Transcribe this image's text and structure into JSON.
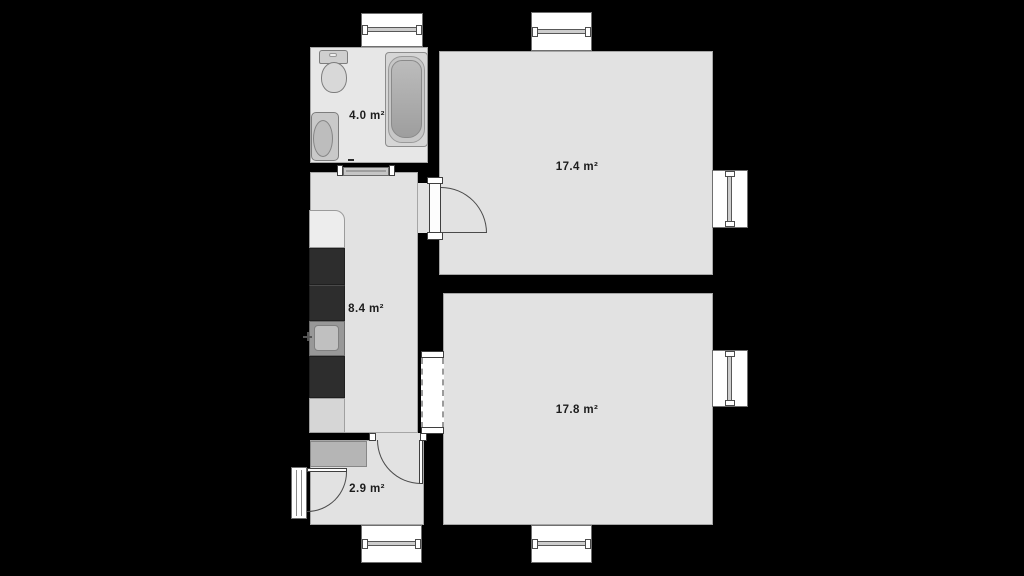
{
  "plan": {
    "title": "apartment floor plan",
    "rooms": [
      {
        "name": "bathroom",
        "area_label": "4.0 m²"
      },
      {
        "name": "room-upper",
        "area_label": "17.4 m²"
      },
      {
        "name": "kitchen",
        "area_label": "8.4 m²"
      },
      {
        "name": "room-lower",
        "area_label": "17.8 m²"
      },
      {
        "name": "entry",
        "area_label": "2.9 m²"
      }
    ],
    "fixtures": [
      "toilet",
      "bathroom-sink",
      "bathtub",
      "kitchen-counter",
      "stove",
      "kitchen-sink",
      "entry-shelf"
    ],
    "openings": {
      "windows": 6,
      "doors": [
        "door-room-upper",
        "door-entry-kitchen",
        "front-door",
        "sliding-door-bathroom"
      ],
      "passages": [
        "dashed-opening-kitchen-room-lower"
      ]
    },
    "colors": {
      "background": "#000000",
      "wall": "#000000",
      "floor": "#e2e2e2",
      "window": "#ffffff",
      "appliance_dark": "#2d2d2d",
      "fixture_gray": "#c9c9c9",
      "label_text": "#1c1c1c"
    }
  }
}
